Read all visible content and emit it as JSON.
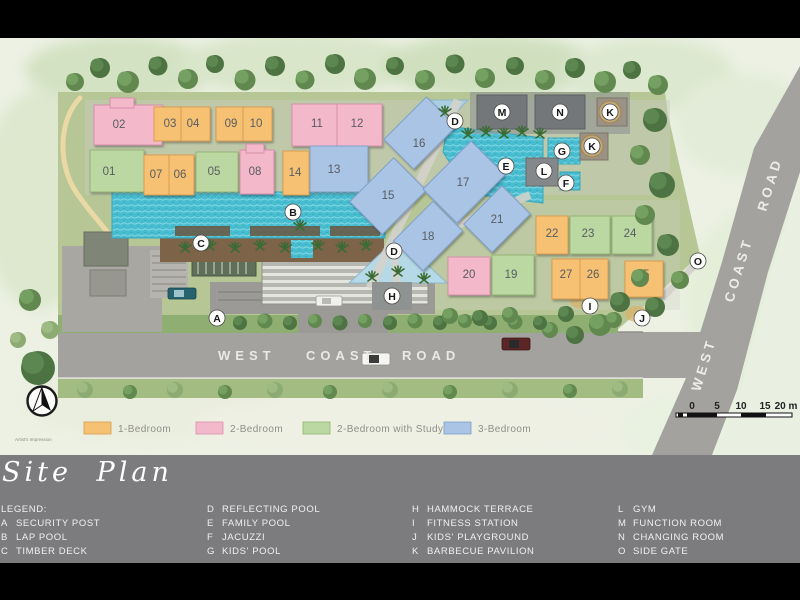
{
  "colors": {
    "unit_1br": "#f7c173",
    "unit_2br": "#f4b8cb",
    "unit_2br_study": "#bcd8a2",
    "unit_3br": "#a9c4e4",
    "pool_water": "#48bdd0",
    "road_gray": "#a3a29e",
    "panel_gray": "#7c7c7e"
  },
  "buildings": [
    {
      "num": "01"
    },
    {
      "num": "02"
    },
    {
      "num": "03"
    },
    {
      "num": "04"
    },
    {
      "num": "05"
    },
    {
      "num": "06"
    },
    {
      "num": "07"
    },
    {
      "num": "08"
    },
    {
      "num": "09"
    },
    {
      "num": "10"
    },
    {
      "num": "11"
    },
    {
      "num": "12"
    },
    {
      "num": "13"
    },
    {
      "num": "14"
    },
    {
      "num": "15"
    },
    {
      "num": "16"
    },
    {
      "num": "17"
    },
    {
      "num": "18"
    },
    {
      "num": "19"
    },
    {
      "num": "20"
    },
    {
      "num": "21"
    },
    {
      "num": "22"
    },
    {
      "num": "23"
    },
    {
      "num": "24"
    },
    {
      "num": "25"
    },
    {
      "num": "26"
    },
    {
      "num": "27"
    }
  ],
  "markers": [
    {
      "letter": "A"
    },
    {
      "letter": "B"
    },
    {
      "letter": "C"
    },
    {
      "letter": "D"
    },
    {
      "letter": "D"
    },
    {
      "letter": "E"
    },
    {
      "letter": "F"
    },
    {
      "letter": "G"
    },
    {
      "letter": "H"
    },
    {
      "letter": "I"
    },
    {
      "letter": "J"
    },
    {
      "letter": "K"
    },
    {
      "letter": "K"
    },
    {
      "letter": "L"
    },
    {
      "letter": "M"
    },
    {
      "letter": "N"
    },
    {
      "letter": "O"
    }
  ],
  "roads": {
    "bottom": [
      "WEST",
      "COAST",
      "ROAD"
    ],
    "side": [
      "WEST",
      "COAST",
      "ROAD"
    ]
  },
  "unit_legend": [
    {
      "label": "1-Bedroom"
    },
    {
      "label": "2-Bedroom"
    },
    {
      "label": "2-Bedroom with Study"
    },
    {
      "label": "3-Bedroom"
    }
  ],
  "scale_bar": {
    "ticks": [
      "0",
      "5",
      "10",
      "15",
      "20 m"
    ]
  },
  "notes": {
    "artists_impression": "Artist's Impression"
  },
  "panel": {
    "title": "Site Plan",
    "legend_heading": "LEGEND:",
    "col1": [
      {
        "key": "A",
        "label": "SECURITY POST"
      },
      {
        "key": "B",
        "label": "LAP POOL"
      },
      {
        "key": "C",
        "label": "TIMBER DECK"
      }
    ],
    "col2": [
      {
        "key": "D",
        "label": "REFLECTING POOL"
      },
      {
        "key": "E",
        "label": "FAMILY POOL"
      },
      {
        "key": "F",
        "label": "JACUZZI"
      },
      {
        "key": "G",
        "label": "KIDS' POOL"
      }
    ],
    "col3": [
      {
        "key": "H",
        "label": "HAMMOCK TERRACE"
      },
      {
        "key": "I",
        "label": "FITNESS STATION"
      },
      {
        "key": "J",
        "label": "KIDS' PLAYGROUND"
      },
      {
        "key": "K",
        "label": "BARBECUE PAVILION"
      }
    ],
    "col4": [
      {
        "key": "L",
        "label": "GYM"
      },
      {
        "key": "M",
        "label": "FUNCTION ROOM"
      },
      {
        "key": "N",
        "label": "CHANGING ROOM"
      },
      {
        "key": "O",
        "label": "SIDE GATE"
      }
    ]
  }
}
